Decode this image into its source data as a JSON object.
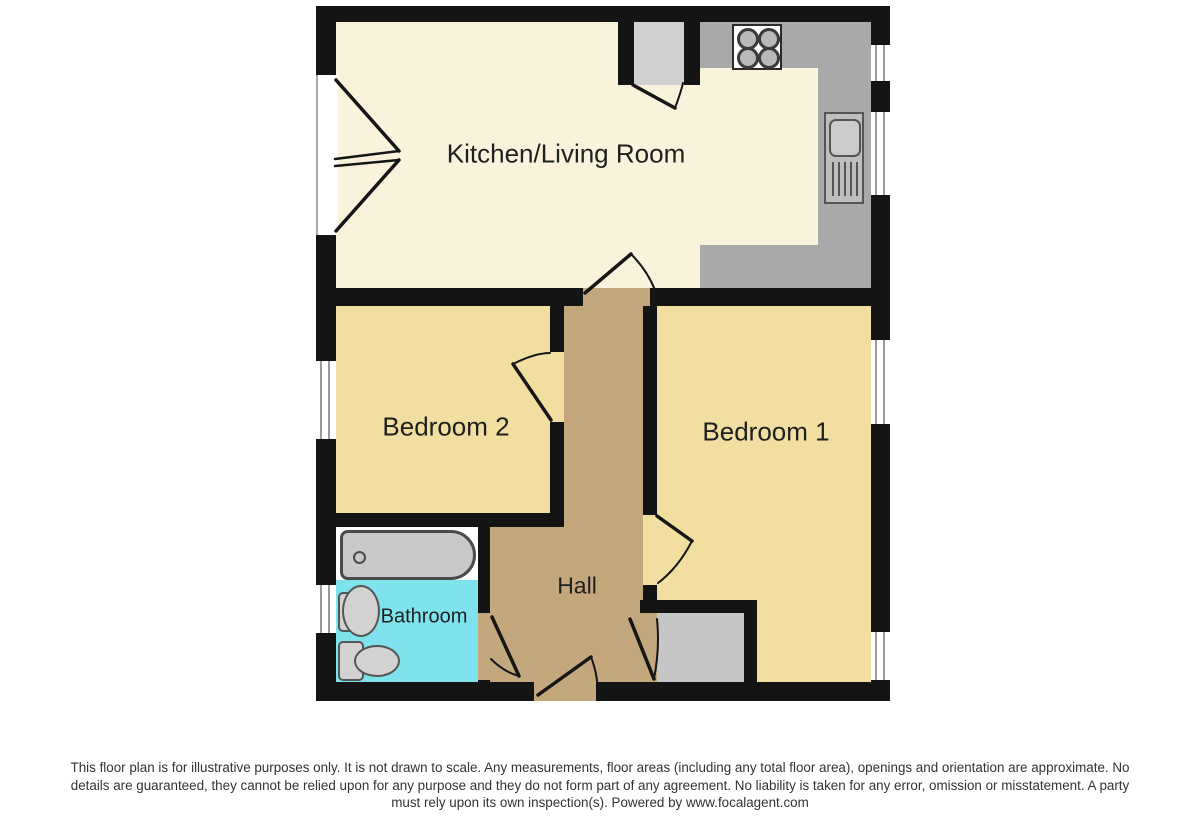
{
  "floor_plan": {
    "rooms": {
      "kitchen_living": {
        "label": "Kitchen/Living Room"
      },
      "bedroom2": {
        "label": "Bedroom 2"
      },
      "bedroom1": {
        "label": "Bedroom 1"
      },
      "hall": {
        "label": "Hall"
      },
      "bathroom": {
        "label": "Bathroom"
      }
    },
    "fixtures": {
      "hob": "4-ring hob",
      "kitchen_sink": "sink with drainer",
      "utility_cupboard": "cupboard off kitchen",
      "bathtub": "bath",
      "wash_basin": "basin",
      "toilet": "WC",
      "storage_cupboard": "hall storage cupboard"
    },
    "colors": {
      "walls": "#141414",
      "kitchen_floor": "#f8f3da",
      "bedroom_floor": "#f3dea1",
      "hall_floor": "#c4a77d",
      "bathroom_floor": "#7fe3ed",
      "counter": "#a9a9a9",
      "cupboard": "#d0d0d0",
      "background": "#ffffff"
    }
  },
  "disclaimer": {
    "line1": "This floor plan is for illustrative purposes only. It is not drawn to scale. Any measurements, floor areas (including any total floor area), openings and orientation are approximate. No",
    "line2": "details are guaranteed, they cannot be relied upon for any purpose and they do not form part of any agreement. No liability is taken for any error, omission or misstatement. A party",
    "line3": "must rely upon its own inspection(s). Powered by www.focalagent.com"
  }
}
